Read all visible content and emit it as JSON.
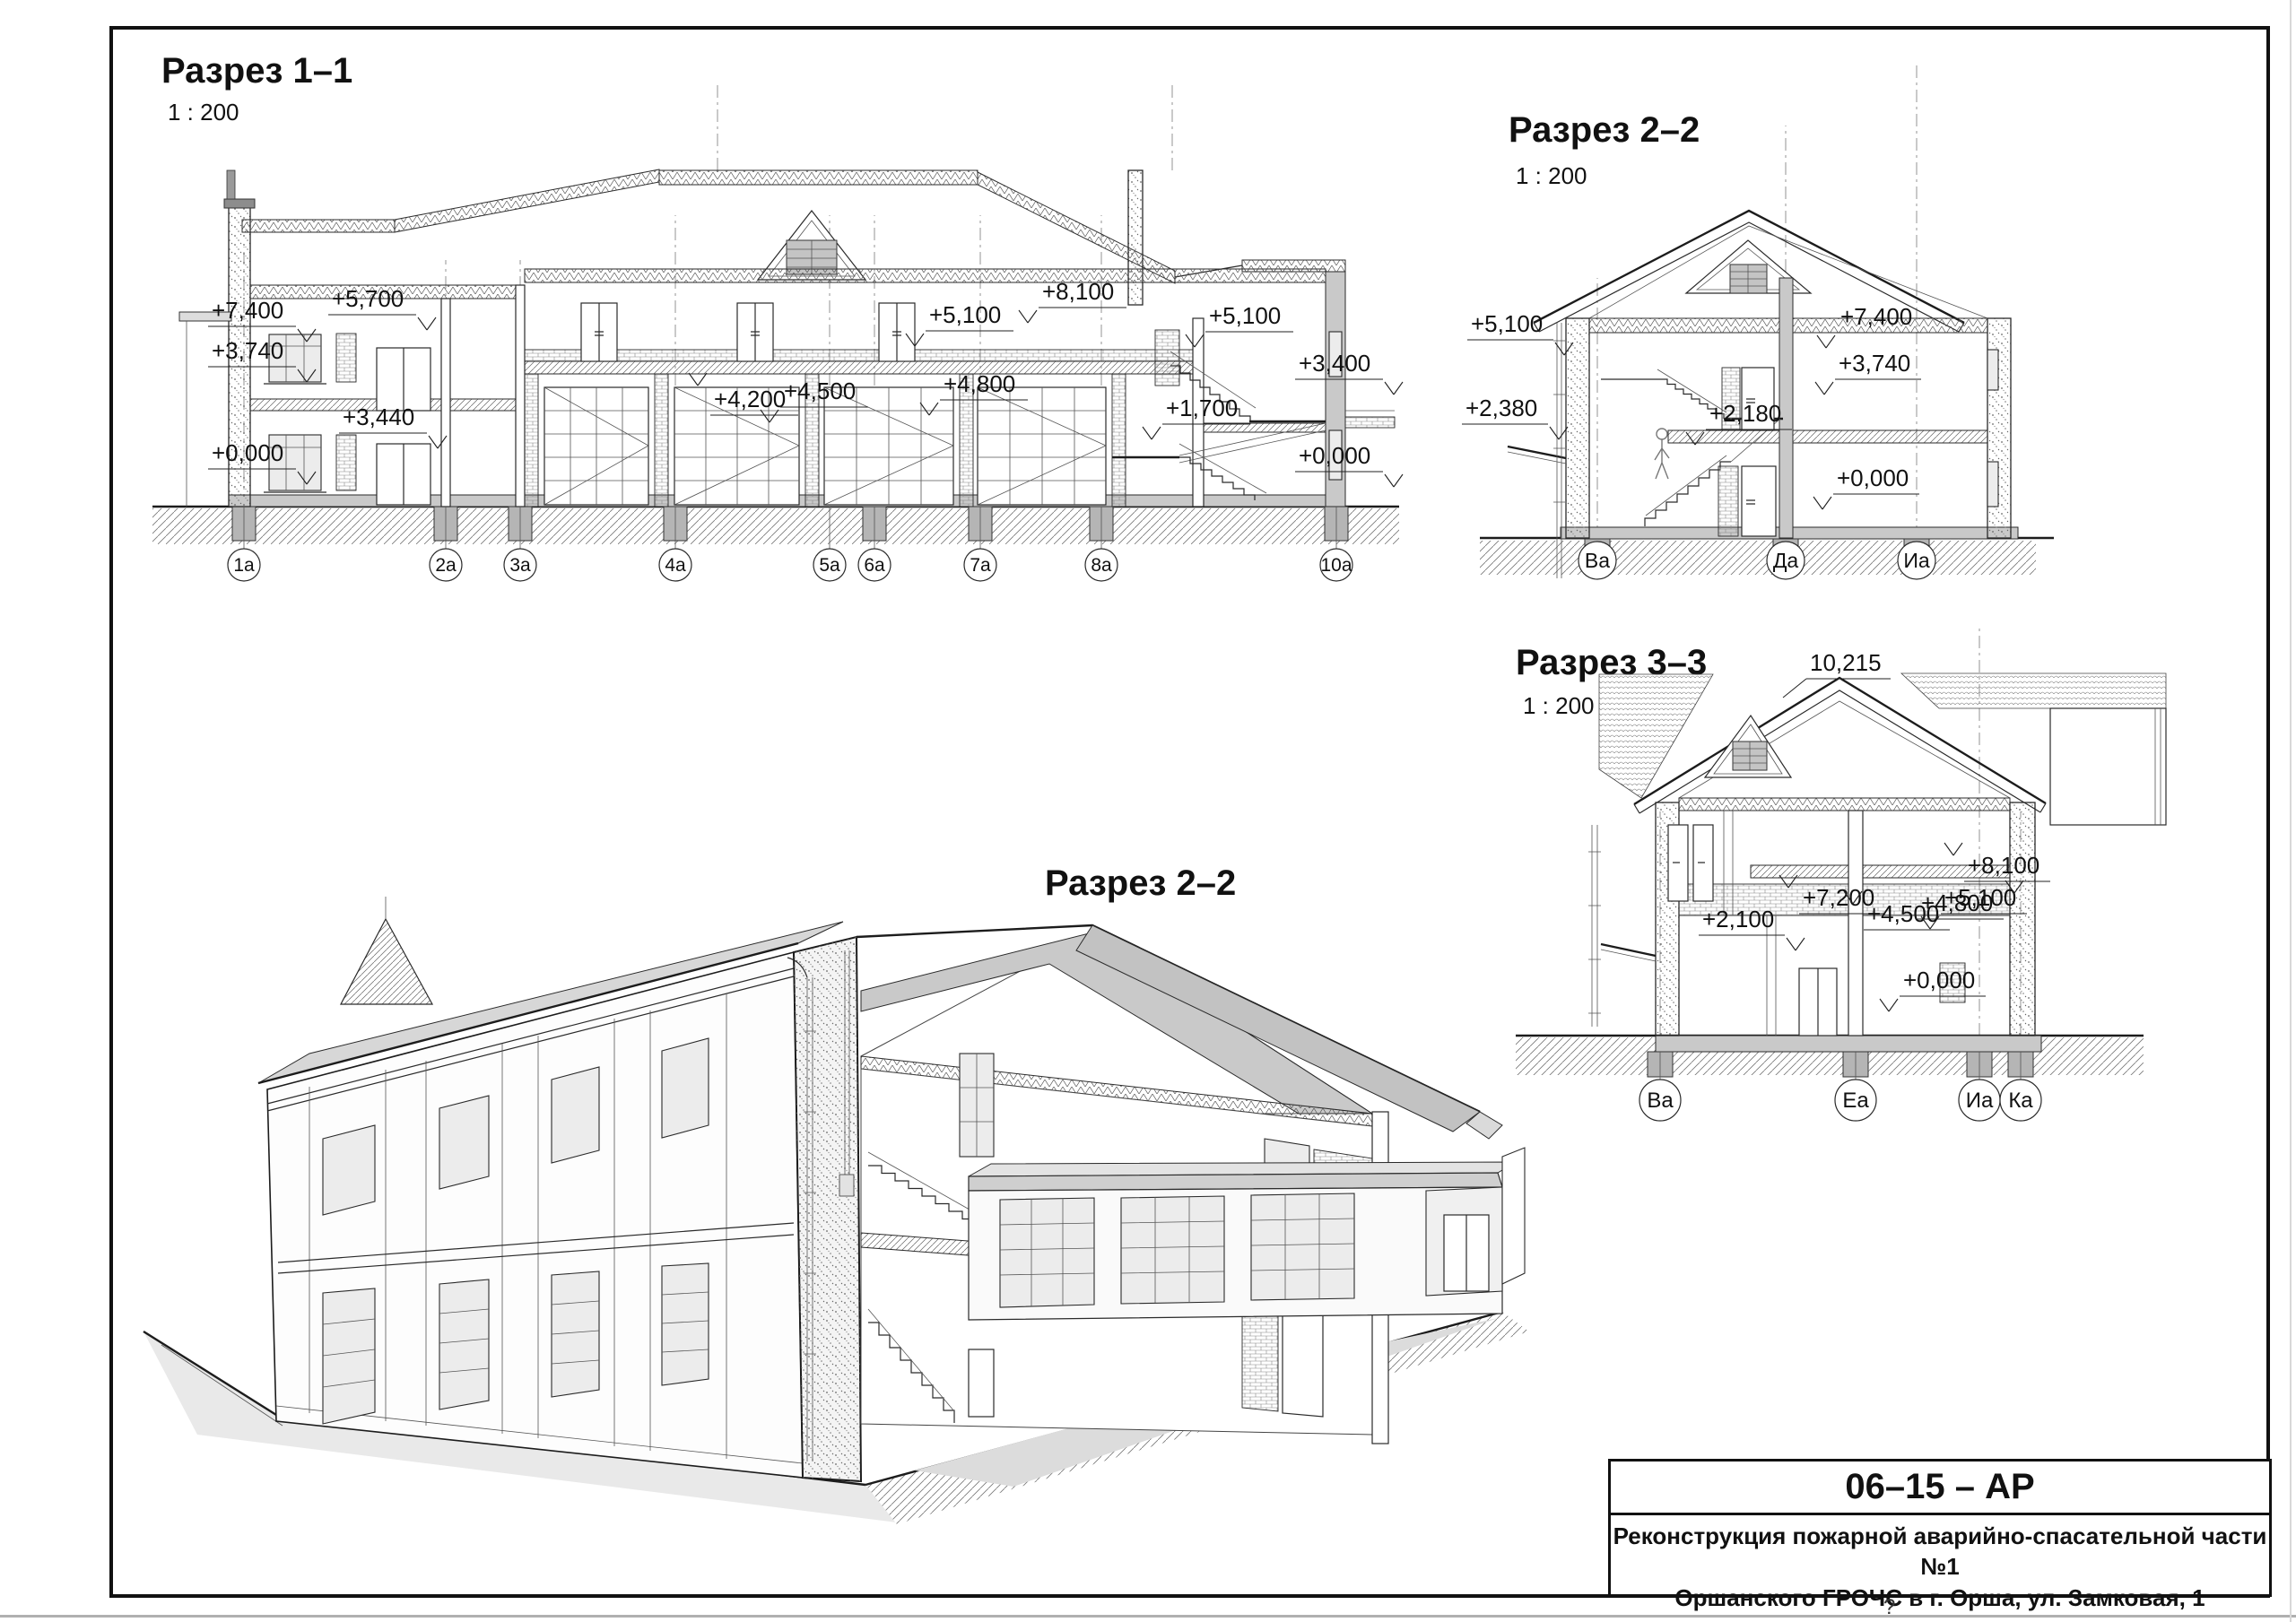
{
  "sheet": {
    "doc_code": "06–15 – АР",
    "project_title_line1": "Реконструкция пожарной аварийно-спасательной части №1",
    "project_title_line2": "Оршанского ГРОЧС в г. Орша, ул. Замковая, 1",
    "footer_question_mark": "?"
  },
  "section_1_1": {
    "title": "Разрез 1–1",
    "scale": "1 : 200",
    "elevation_marks": [
      "+7,400",
      "+5,700",
      "+3,740",
      "+3,440",
      "+0,000",
      "+4,200",
      "+4,500",
      "+4,800",
      "+5,100",
      "+8,100",
      "+5,100",
      "+3,400",
      "+1,700",
      "+0,000"
    ],
    "axis_labels": [
      "1а",
      "2а",
      "3а",
      "4а",
      "5а",
      "6а",
      "7а",
      "8а",
      "10а"
    ]
  },
  "section_2_2": {
    "title": "Разрез 2–2",
    "scale": "1 : 200",
    "elevation_marks": [
      "+5,100",
      "+2,380",
      "+7,400",
      "+3,740",
      "+2,180",
      "+0,000"
    ],
    "axis_labels": [
      "Ва",
      "Да",
      "Иа"
    ]
  },
  "section_3_3": {
    "title": "Разрез 3–3",
    "scale": "1 : 200",
    "ridge_mark": "10,215",
    "elevation_marks": [
      "+8,100",
      "+7,200",
      "+5,100",
      "+4,500",
      "+4,800",
      "+2,100",
      "+0,000"
    ],
    "axis_labels": [
      "Ва",
      "Еа",
      "Иа",
      "Ка"
    ]
  },
  "perspective_view": {
    "title": "Разрез 2–2"
  }
}
